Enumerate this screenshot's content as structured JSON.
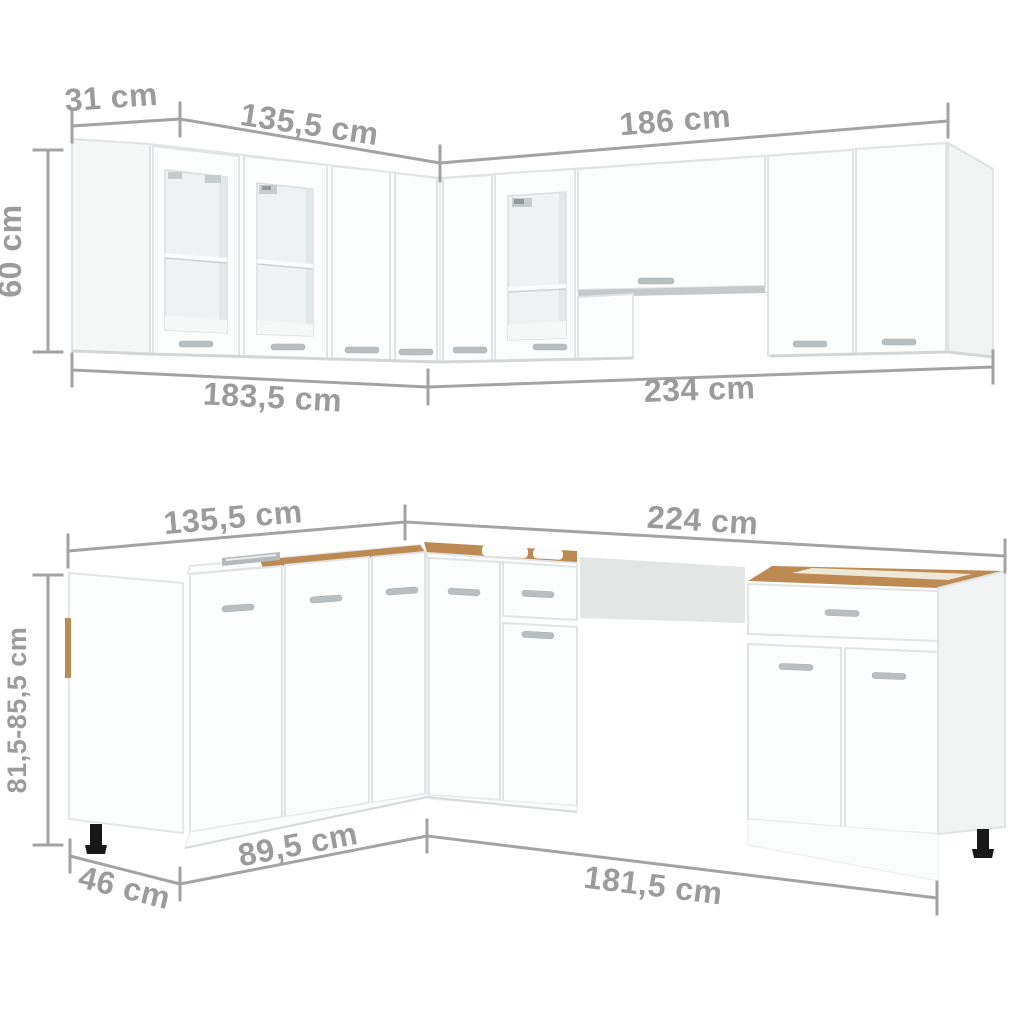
{
  "page": {
    "title": "Kitchen cabinet set dimensions diagram",
    "unit": "cm",
    "background": "#ffffff"
  },
  "palette": {
    "dimension_text": "#9b9b9b",
    "dimension_line": "#a3a3a3",
    "cabinet_fill": "#fdfefe",
    "cabinet_outline": "#e2e6e6",
    "side_panel": "#f2f4f4",
    "glass": "#eff2f2",
    "wood_top": "#bc8a52",
    "appliance_gap": "#e4e6e6",
    "foot": "#181818"
  },
  "upper_section": {
    "name": "wall-cabinets",
    "labels": {
      "height": "60 cm",
      "side_depth": "31 cm",
      "top_left_width": "135,5 cm",
      "top_right_width": "186 cm",
      "bottom_left_width": "183,5 cm",
      "bottom_right_width": "234 cm"
    }
  },
  "lower_section": {
    "name": "base-cabinets",
    "labels": {
      "height": "81,5-85,5 cm",
      "top_left_width": "135,5 cm",
      "top_right_width": "224 cm",
      "end_depth": "46 cm",
      "bottom_left_width": "89,5 cm",
      "bottom_right_width": "181,5 cm"
    }
  }
}
